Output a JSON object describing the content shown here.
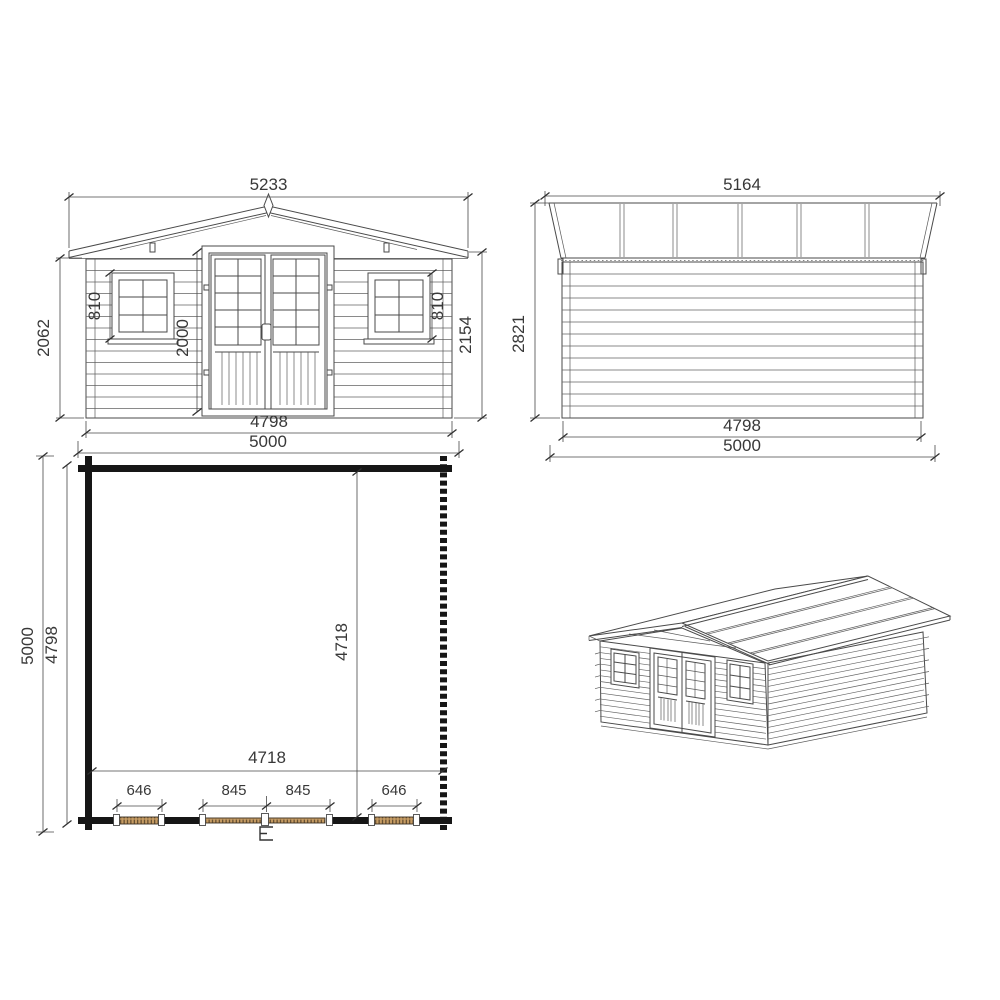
{
  "sheet": {
    "background": "#ffffff",
    "line_color": "#4a4a4a",
    "plan_wall_color": "#161616",
    "plan_fitting_fill": "#c59b63",
    "text_color": "#383838"
  },
  "front_elevation": {
    "dim_roof_width": "5233",
    "dim_left_wall_height": "2062",
    "dim_right_total_height": "2154",
    "dim_left_window_height": "810",
    "dim_right_window_height": "810",
    "dim_door_height": "2000",
    "dim_wall_outer_width": "4798",
    "dim_base_width": "5000"
  },
  "side_elevation": {
    "dim_roof_length": "5164",
    "dim_total_height": "2821",
    "dim_wall_outer_length": "4798",
    "dim_base_length": "5000"
  },
  "floor_plan": {
    "dim_outer_depth": "5000",
    "dim_wall_outer_depth": "4798",
    "dim_interior_depth": "4718",
    "dim_interior_width": "4718",
    "dim_left_window_width": "646",
    "dim_left_door_leaf_width": "845",
    "dim_right_door_leaf_width": "845",
    "dim_right_window_width": "646"
  }
}
